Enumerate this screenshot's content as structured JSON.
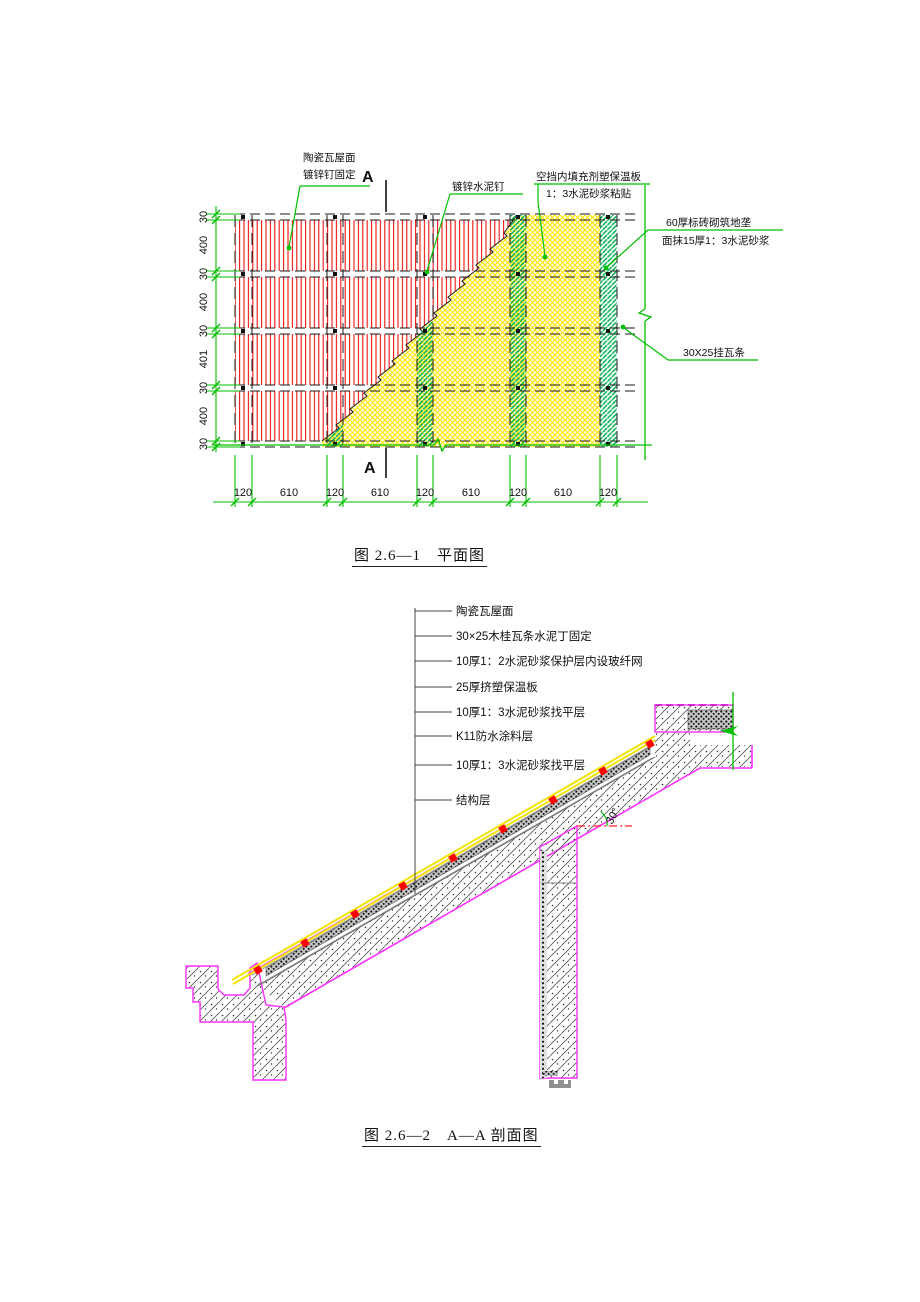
{
  "figure1": {
    "caption": "图 2.6—1　平面图",
    "section_marker": "A",
    "labels": {
      "tile_roof_1": "陶瓷瓦屋面",
      "tile_roof_2": "镀锌钉固定",
      "nail": "镀锌水泥钉",
      "insulation_1": "空挡内填充剂塑保温板",
      "insulation_2": "1：3水泥砂浆粘贴",
      "brick_1": "60厚标砖砌筑地垄",
      "brick_2": "面抹15厚1：3水泥砂浆",
      "batten": "30X25挂瓦条"
    },
    "dims_left": [
      "30",
      "400",
      "30",
      "400",
      "30",
      "401",
      "30",
      "400",
      "30"
    ],
    "dims_bottom": [
      "120",
      "610",
      "120",
      "610",
      "120",
      "610",
      "120",
      "610",
      "120"
    ]
  },
  "figure2": {
    "caption": "图 2.6—2　A—A 剖面图",
    "angle": "30°",
    "layers": [
      "陶瓷瓦屋面",
      "30×25木桂瓦条水泥丁固定",
      "10厚1：2水泥砂浆保护层内设玻纤网",
      "25厚挤塑保温板",
      "10厚1：3水泥砂浆找平层",
      "K11防水涂料层",
      "10厚1：3水泥砂浆找平层",
      "结构层"
    ]
  },
  "colors": {
    "dimension_green": "#00c000",
    "hatch_red": "#ee1111",
    "insulation_yellow": "#ffe600",
    "outline_magenta": "#ff30ff",
    "line_black": "#1a1a1a"
  }
}
